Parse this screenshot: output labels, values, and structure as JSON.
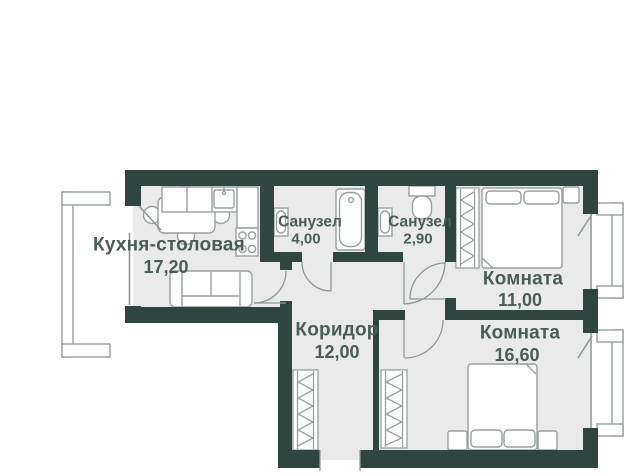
{
  "plan": {
    "type": "apartment-floor-plan",
    "rooms": [
      {
        "id": "kitchen",
        "label": "Кухня-столовая",
        "area": "17,20"
      },
      {
        "id": "bathroom-1",
        "label": "Санузел",
        "area": "4,00"
      },
      {
        "id": "bathroom-2",
        "label": "Санузел",
        "area": "2,90"
      },
      {
        "id": "room-1",
        "label": "Комната",
        "area": "11,00"
      },
      {
        "id": "corridor",
        "label": "Коридор",
        "area": "12,00"
      },
      {
        "id": "room-2",
        "label": "Комната",
        "area": "16,60"
      }
    ],
    "colors": {
      "wall": "#2e463f",
      "floor": "#e9eae9",
      "furniture_line": "#97a09e",
      "thin_line": "#8f9996",
      "text": "#4a5c56",
      "background": "#ffffff"
    }
  }
}
